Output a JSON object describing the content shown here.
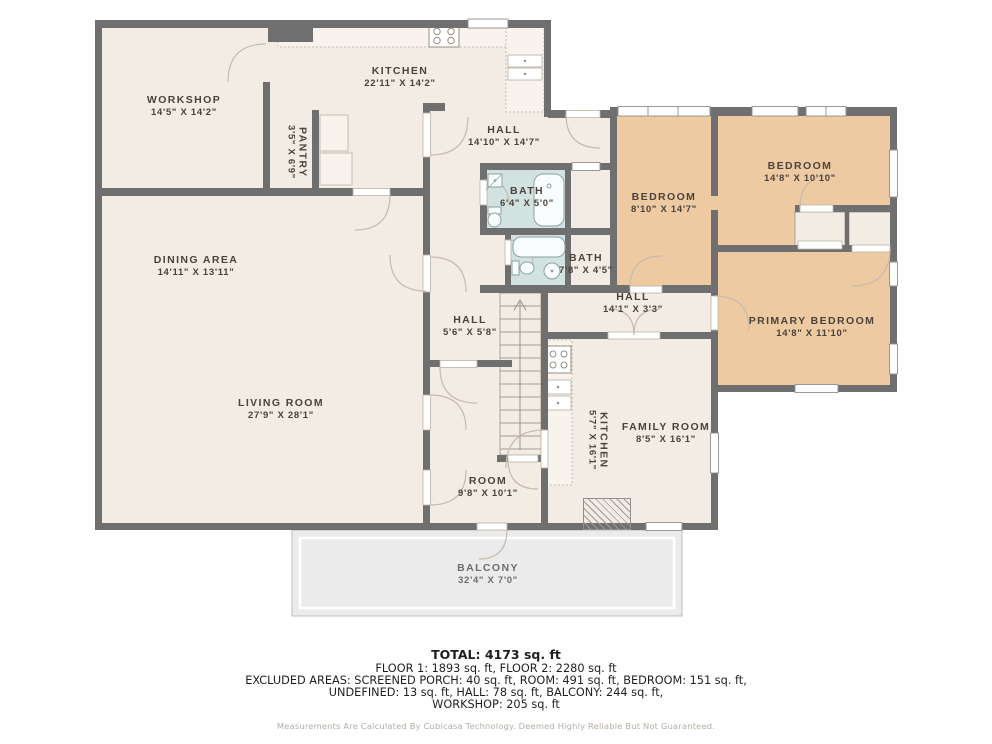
{
  "plan": {
    "rooms": {
      "workshop": {
        "name": "WORKSHOP",
        "dims": "14'5\" X 14'2\""
      },
      "kitchen": {
        "name": "KITCHEN",
        "dims": "22'11\" X 14'2\""
      },
      "pantry": {
        "name": "PANTRY",
        "dims": "3'5\" X 6'9\""
      },
      "hall_upper": {
        "name": "HALL",
        "dims": "14'10\" X 14'7\""
      },
      "bath_small": {
        "name": "BATH",
        "dims": "6'4\" X 5'0\""
      },
      "bath_lower": {
        "name": "BATH",
        "dims": "7'8\" X 4'5\""
      },
      "bedroom_left": {
        "name": "BEDROOM",
        "dims": "8'10\" X 14'7\""
      },
      "bedroom_right": {
        "name": "BEDROOM",
        "dims": "14'8\" X 10'10\""
      },
      "primary_bedroom": {
        "name": "PRIMARY BEDROOM",
        "dims": "14'8\" X 11'10\""
      },
      "dining_area": {
        "name": "DINING AREA",
        "dims": "14'11\" X 13'11\""
      },
      "living_room": {
        "name": "LIVING ROOM",
        "dims": "27'9\" X 28'1\""
      },
      "hall_small": {
        "name": "HALL",
        "dims": "5'6\" X 5'8\""
      },
      "hall_narrow": {
        "name": "HALL",
        "dims": "14'1\" X 3'3\""
      },
      "kitchen_lower": {
        "name": "KITCHEN",
        "dims": "5'7\" X 16'1\""
      },
      "family_room": {
        "name": "FAMILY ROOM",
        "dims": "8'5\" X 16'1\""
      },
      "room": {
        "name": "ROOM",
        "dims": "9'8\" X 10'1\""
      },
      "balcony": {
        "name": "BALCONY",
        "dims": "32'4\" X 7'0\""
      }
    },
    "colors": {
      "wall": "#6f6f6f",
      "floor": "#f2ece4",
      "bedroom_fill": "#eecaa3",
      "bath_fill": "#d2e2e1",
      "balcony_fill": "#ebebeb",
      "door_arc": "#c6bbad"
    }
  },
  "summary": {
    "total": "TOTAL: 4173 sq. ft",
    "line_floors": "FLOOR 1: 1893 sq. ft, FLOOR 2: 2280 sq. ft",
    "line_excluded_1": "EXCLUDED AREAS: SCREENED PORCH: 40 sq. ft, ROOM: 491 sq. ft, BEDROOM: 151 sq. ft,",
    "line_excluded_2": "UNDEFINED: 13 sq. ft, HALL: 78 sq. ft, BALCONY: 244 sq. ft,",
    "line_excluded_3": "WORKSHOP: 205 sq. ft",
    "disclaimer": "Measurements Are Calculated By Cubicasa Technology. Deemed Highly Reliable But Not Guaranteed."
  }
}
